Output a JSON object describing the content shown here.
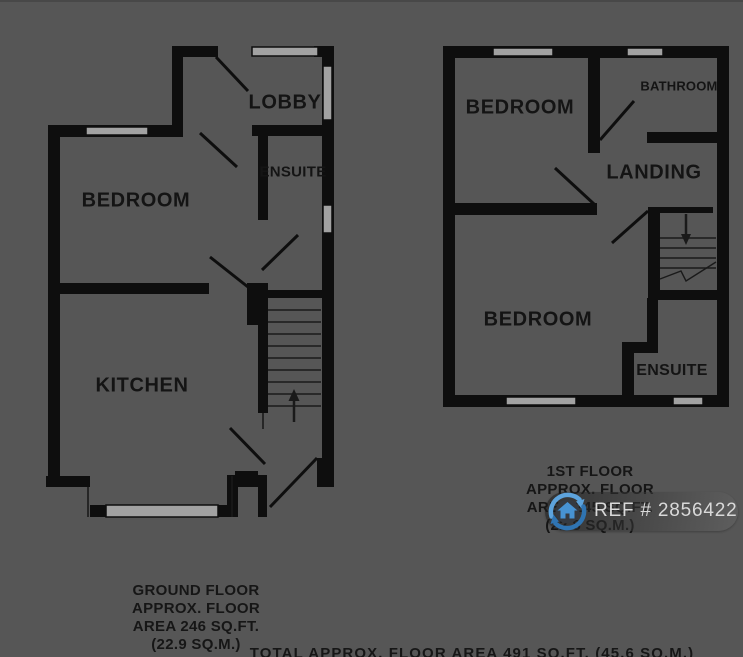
{
  "meta": {
    "description": "Two-storey property floorplan",
    "colors": {
      "background": "#565656",
      "wall": "#0e0e0e",
      "window_fill": "#a2a2a2",
      "label_text": "#141414",
      "badge_pill": "rgba(40,40,40,0.6)",
      "badge_text": "#d9d9d9",
      "logo_blue_light": "#5da3dc",
      "logo_blue_dark": "#2f74b2",
      "logo_disc": "#353a41"
    }
  },
  "ground_floor": {
    "plan_name": "Ground floor plan",
    "rooms": [
      {
        "label": "LOBBY"
      },
      {
        "label": "ENSUITE"
      },
      {
        "label": "BEDROOM"
      },
      {
        "label": "KITCHEN"
      }
    ],
    "stairs_direction": "up",
    "caption_lines": [
      "GROUND FLOOR",
      "APPROX. FLOOR",
      "AREA 246 SQ.FT.",
      "(22.9 SQ.M.)"
    ]
  },
  "first_floor": {
    "plan_name": "First floor plan",
    "rooms": [
      {
        "label": "BEDROOM"
      },
      {
        "label": "BATHROOM"
      },
      {
        "label": "LANDING"
      },
      {
        "label": "BEDROOM"
      },
      {
        "label": "ENSUITE"
      }
    ],
    "stairs_direction": "down",
    "caption_lines": [
      "1ST FLOOR",
      "APPROX. FLOOR",
      "AREA 245 SQ.FT.",
      "(22.8 SQ.M.)"
    ]
  },
  "total_caption": "TOTAL APPROX. FLOOR AREA 491 SQ.FT. (45.6 SQ.M.)",
  "badge": {
    "ref_text": "REF # 2856422",
    "logo_icon": "house-circular-arrows-icon"
  }
}
